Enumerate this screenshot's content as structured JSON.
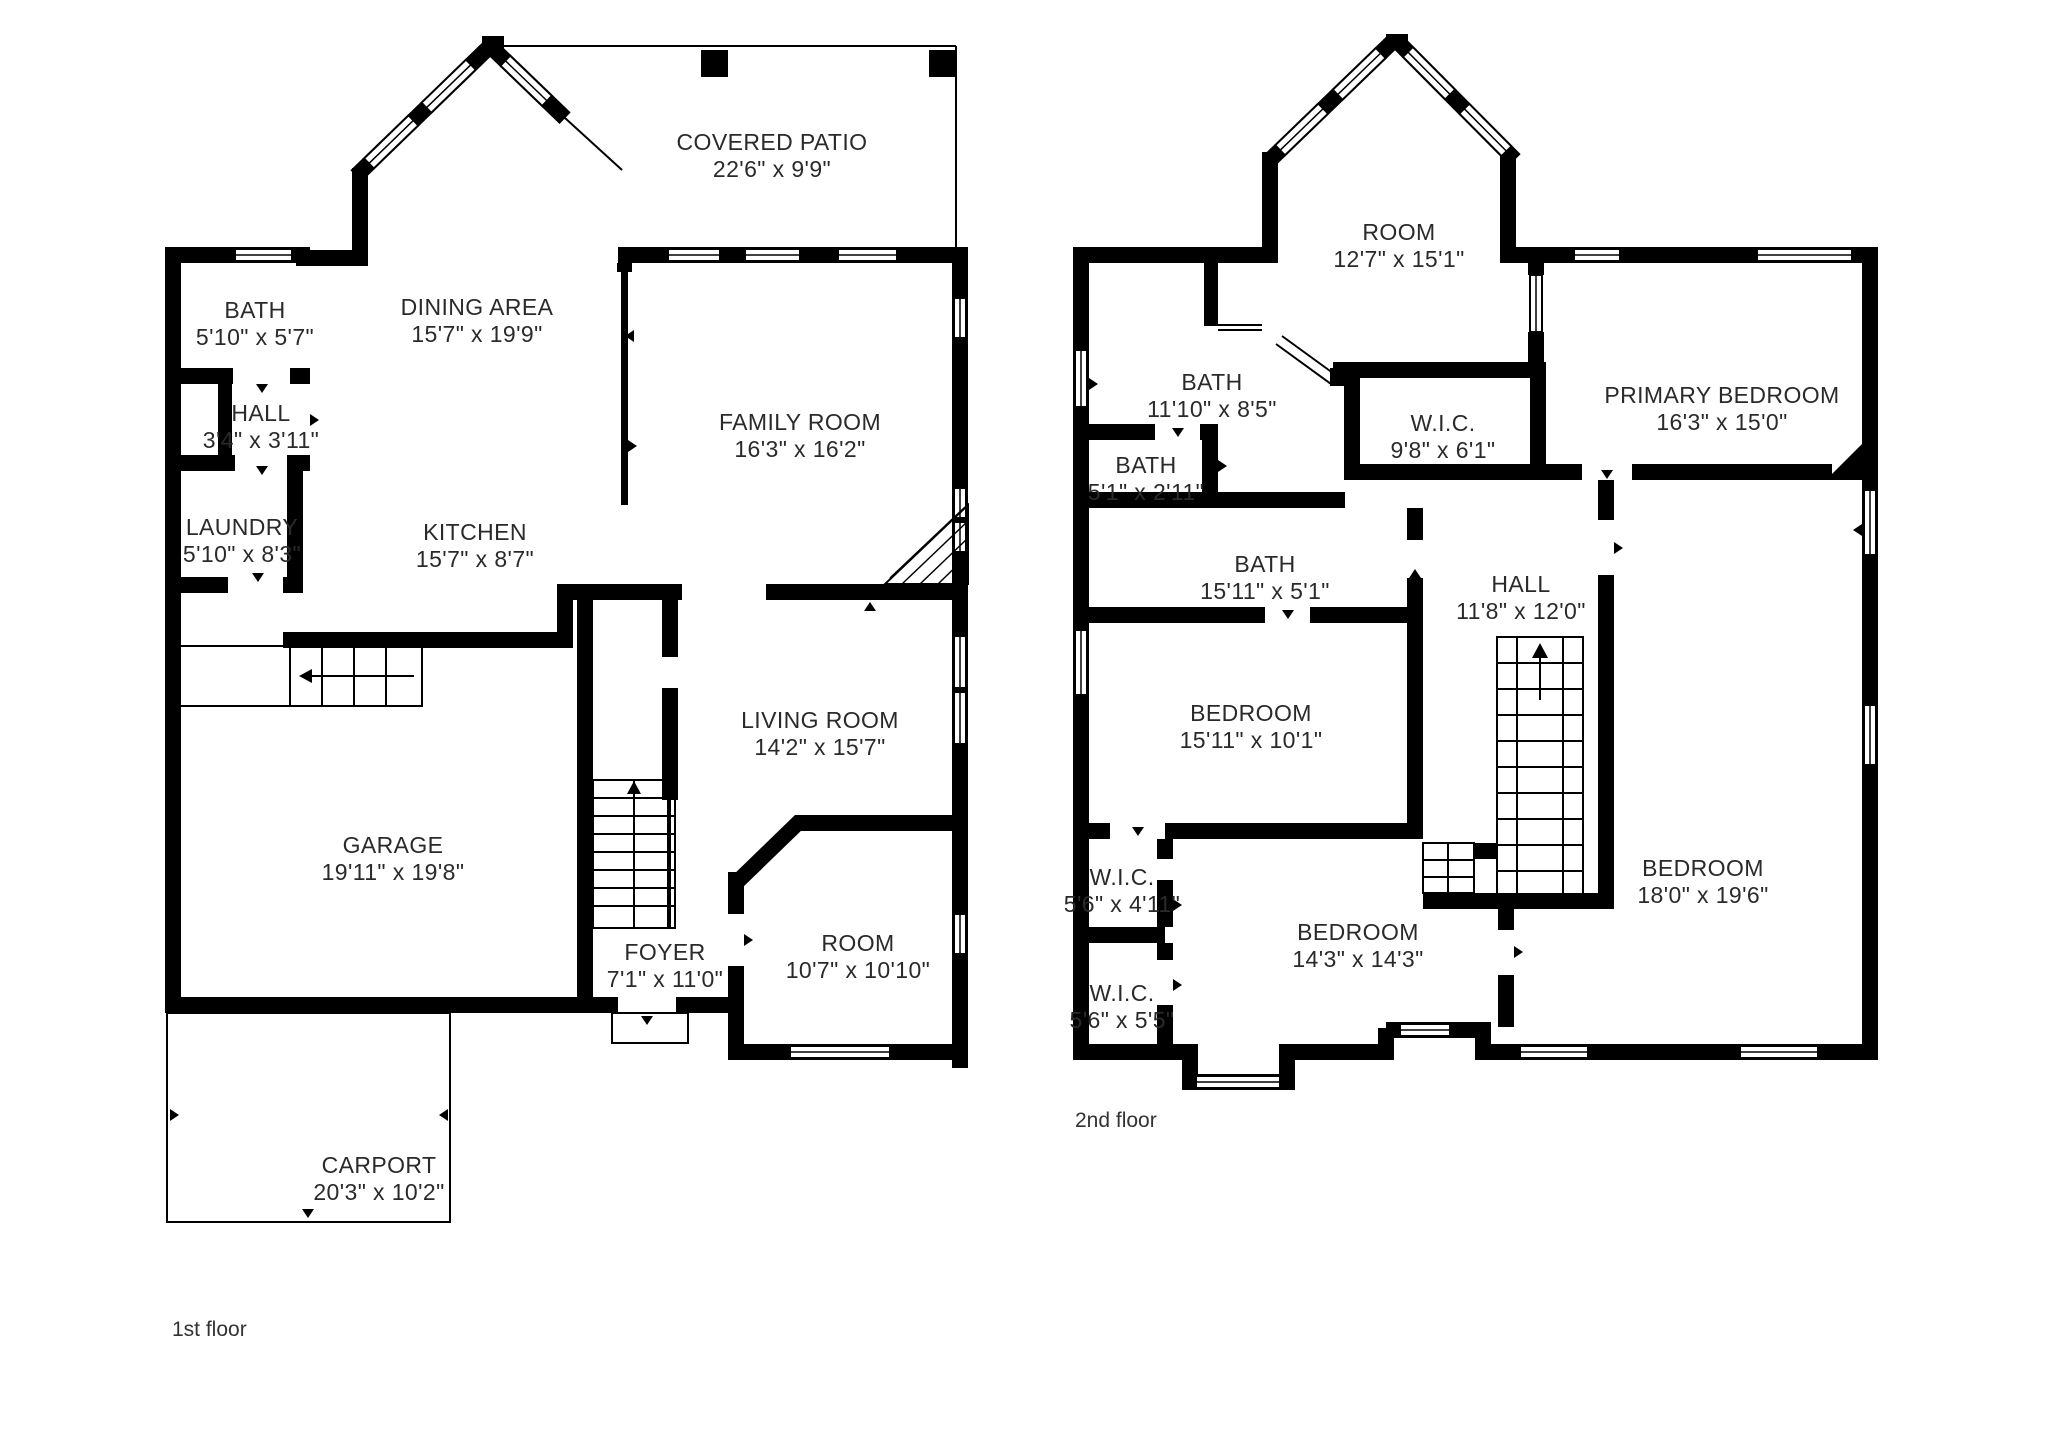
{
  "colors": {
    "walls": "#000000",
    "text": "#2a2a2a",
    "background": "#ffffff"
  },
  "floors": [
    {
      "id": "first",
      "caption": "1st floor",
      "rooms": [
        {
          "id": "bath-1",
          "name": "BATH",
          "dims": "5'10\" x 5'7\"",
          "cx": 255,
          "cy": 318
        },
        {
          "id": "hall-1",
          "name": "HALL",
          "dims": "3'4\" x 3'11\"",
          "cx": 261,
          "cy": 421
        },
        {
          "id": "laundry",
          "name": "LAUNDRY",
          "dims": "5'10\" x 8'3\"",
          "cx": 242,
          "cy": 535
        },
        {
          "id": "dining-area",
          "name": "DINING AREA",
          "dims": "15'7\" x 19'9\"",
          "cx": 477,
          "cy": 315
        },
        {
          "id": "kitchen",
          "name": "KITCHEN",
          "dims": "15'7\" x 8'7\"",
          "cx": 475,
          "cy": 540
        },
        {
          "id": "covered-patio",
          "name": "COVERED PATIO",
          "dims": "22'6\" x 9'9\"",
          "cx": 772,
          "cy": 150
        },
        {
          "id": "family-room",
          "name": "FAMILY ROOM",
          "dims": "16'3\" x 16'2\"",
          "cx": 800,
          "cy": 430
        },
        {
          "id": "living-room",
          "name": "LIVING ROOM",
          "dims": "14'2\" x 15'7\"",
          "cx": 820,
          "cy": 728
        },
        {
          "id": "garage",
          "name": "GARAGE",
          "dims": "19'11\" x 19'8\"",
          "cx": 393,
          "cy": 853
        },
        {
          "id": "foyer",
          "name": "FOYER",
          "dims": "7'1\" x 11'0\"",
          "cx": 665,
          "cy": 960
        },
        {
          "id": "room-1",
          "name": "ROOM",
          "dims": "10'7\" x 10'10\"",
          "cx": 858,
          "cy": 951
        },
        {
          "id": "carport",
          "name": "CARPORT",
          "dims": "20'3\" x 10'2\"",
          "cx": 379,
          "cy": 1173
        }
      ]
    },
    {
      "id": "second",
      "caption": "2nd floor",
      "rooms": [
        {
          "id": "room-2",
          "name": "ROOM",
          "dims": "12'7\" x 15'1\"",
          "cx": 1399,
          "cy": 240
        },
        {
          "id": "bath-2",
          "name": "BATH",
          "dims": "11'10\" x 8'5\"",
          "cx": 1212,
          "cy": 390
        },
        {
          "id": "bath-3",
          "name": "BATH",
          "dims": "5'1\" x 2'11\"",
          "cx": 1146,
          "cy": 473
        },
        {
          "id": "wic-1",
          "name": "W.I.C.",
          "dims": "9'8\" x 6'1\"",
          "cx": 1443,
          "cy": 431
        },
        {
          "id": "primary-bedroom",
          "name": "PRIMARY BEDROOM",
          "dims": "16'3\" x 15'0\"",
          "cx": 1722,
          "cy": 403
        },
        {
          "id": "bath-4",
          "name": "BATH",
          "dims": "15'11\" x 5'1\"",
          "cx": 1265,
          "cy": 572
        },
        {
          "id": "hall-2",
          "name": "HALL",
          "dims": "11'8\" x 12'0\"",
          "cx": 1521,
          "cy": 592
        },
        {
          "id": "bedroom-1",
          "name": "BEDROOM",
          "dims": "15'11\" x 10'1\"",
          "cx": 1251,
          "cy": 721
        },
        {
          "id": "wic-2",
          "name": "W.I.C.",
          "dims": "5'6\" x 4'11\"",
          "cx": 1122,
          "cy": 885
        },
        {
          "id": "wic-3",
          "name": "W.I.C.",
          "dims": "5'6\" x 5'5\"",
          "cx": 1122,
          "cy": 1001
        },
        {
          "id": "bedroom-2",
          "name": "BEDROOM",
          "dims": "14'3\" x 14'3\"",
          "cx": 1358,
          "cy": 940
        },
        {
          "id": "bedroom-3",
          "name": "BEDROOM",
          "dims": "18'0\" x 19'6\"",
          "cx": 1703,
          "cy": 876
        }
      ]
    }
  ]
}
